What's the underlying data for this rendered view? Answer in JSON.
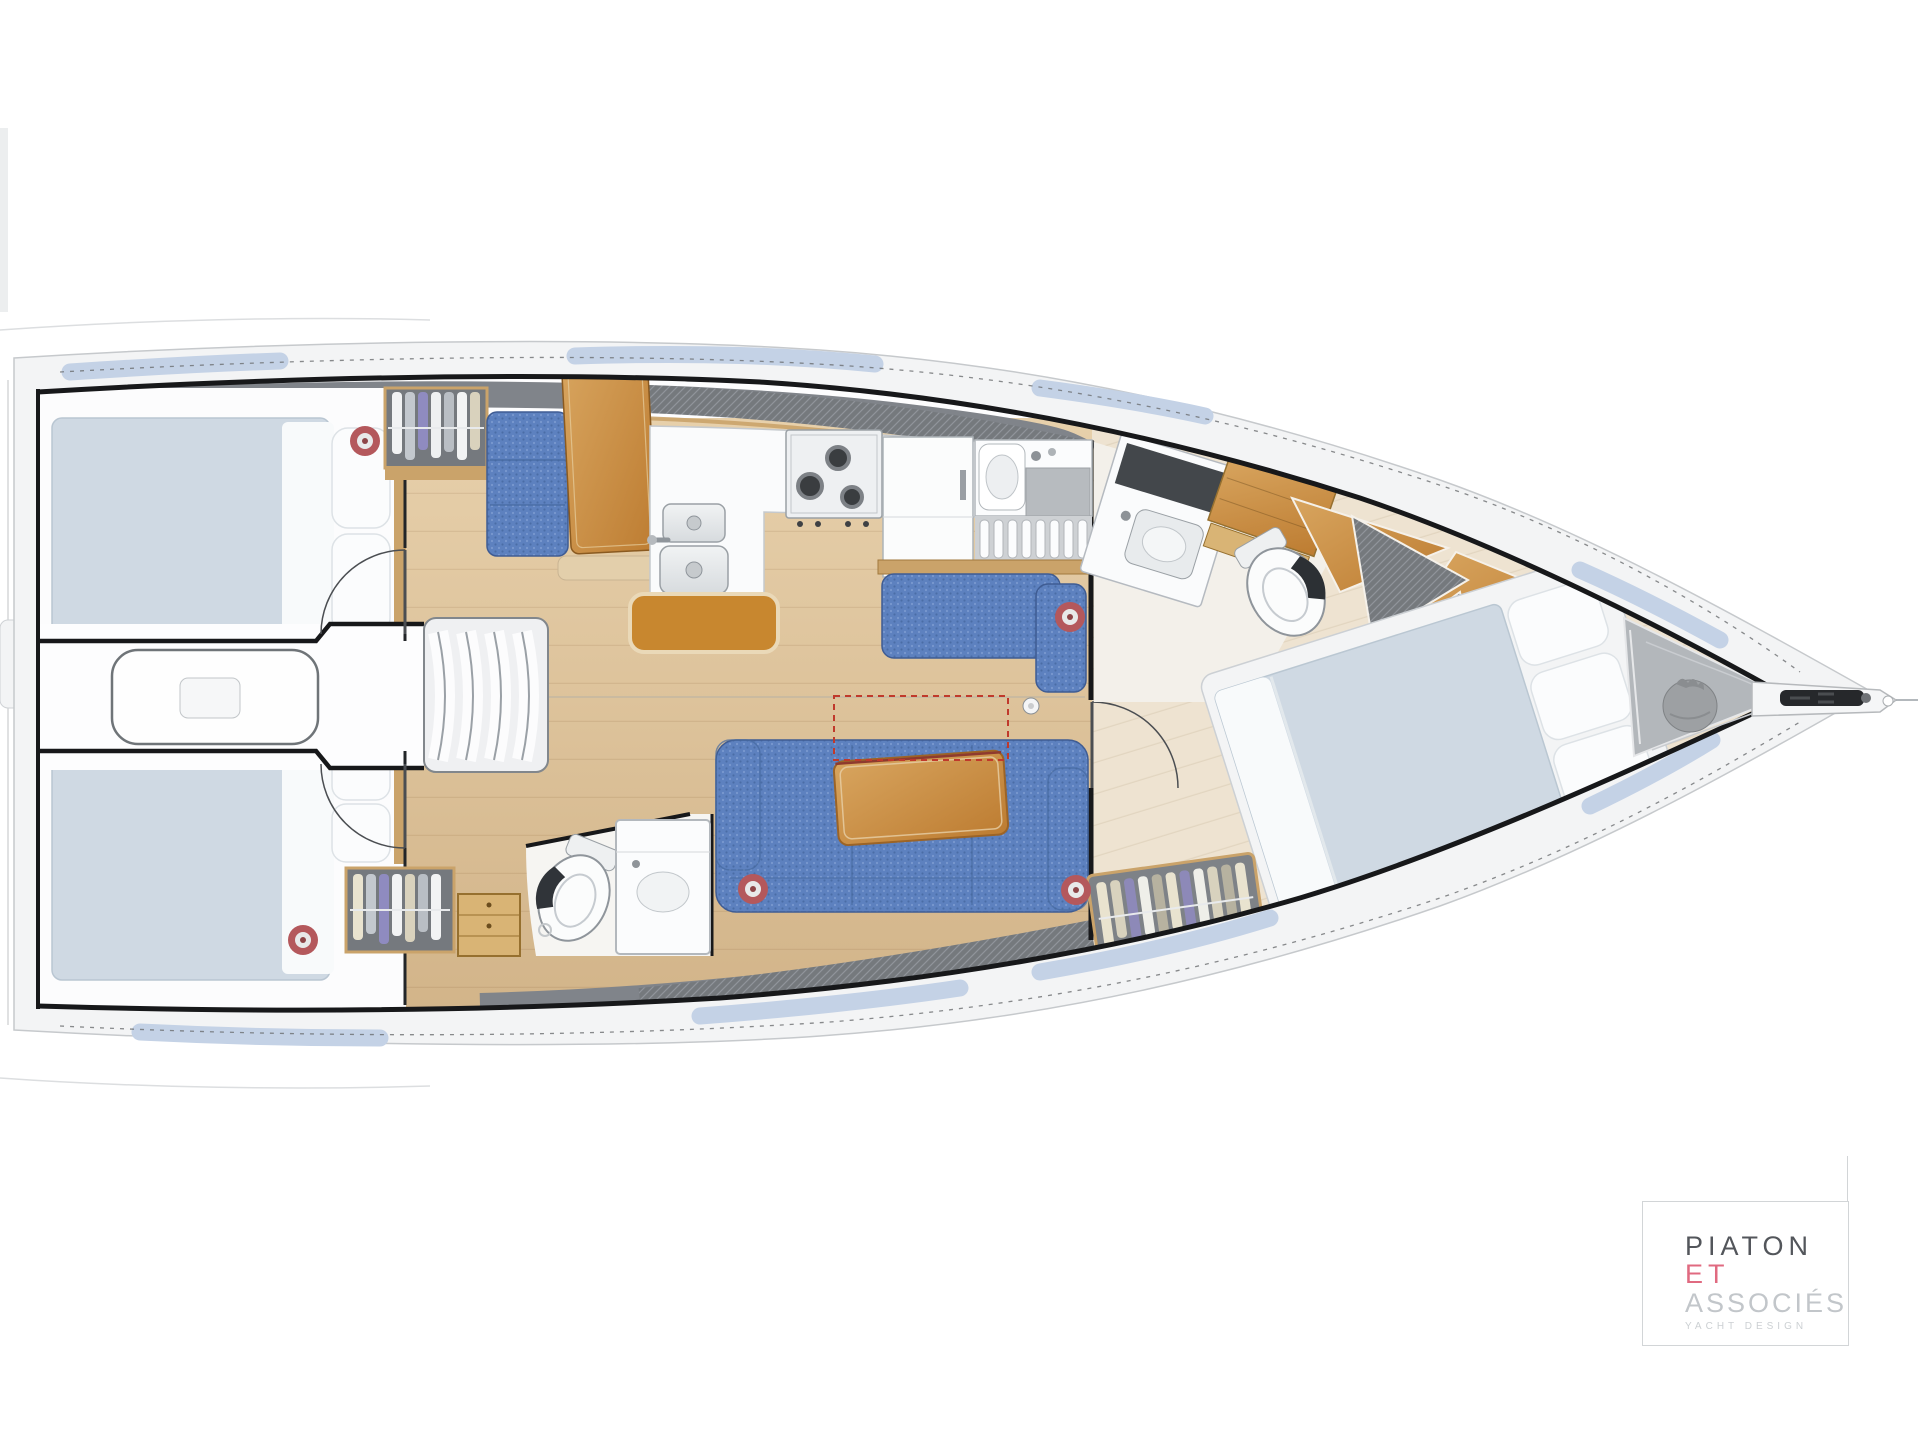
{
  "branding": {
    "name_line1": "PIATON",
    "name_line2": "ET",
    "name_line3": "ASSOCIÉS",
    "tagline": "YACHT DESIGN"
  },
  "plan": {
    "type": "sailing-yacht interior floor plan, overhead view, bow to the right",
    "features": [
      "aft cabin port with double berth",
      "aft cabin starboard with double berth",
      "engine box and companionway steps",
      "hanging wardrobe aft-port",
      "navigation seat and chart table",
      "L-shaped galley with twin sinks, 3-burner stove, refrigerator, wet locker",
      "upper settee with armrest",
      "main saloon settee with fiddled table",
      "folding table extension shown dashed in red",
      "aft heads with toilet and vanity",
      "forward heads with vanity, lockers and toilet",
      "forward cabin island double berth",
      "forward hanging wardrobe",
      "anchor locker with sail bag",
      "bow fitting with anchor roller",
      "five hull portholes marked red",
      "side decks with blue gelcoat strips"
    ]
  },
  "colors": {
    "hullLine": "#17181a",
    "deckBand": "#f3f4f5",
    "deckEdge": "#c6c9cc",
    "stripBlue": "#c4d2e6",
    "grayBand": "#80848a",
    "woodTrim": "#caa36a",
    "floorLight": "#e7d0ab",
    "floorDark": "#d2b489",
    "floorFwd": "#eee3d1",
    "mattress": "#cfd9e3",
    "bedding": "#fbfcfd",
    "fabricBlue": "#5d81bf",
    "fabricDark": "#43669f",
    "orangeWood": "#c8872f",
    "tableLight": "#d8a55f",
    "tableDeep": "#bd7c31",
    "fixtureStroke": "#9aa0a5",
    "portholeRed": "#b4585c",
    "dashRed": "#c0392b",
    "lockerGray": "#75797e",
    "bagGray": "#9da0a3",
    "anchorTri": "#b3b7bb",
    "logoDark": "#53565b",
    "logoPink": "#e06a80",
    "logoGray": "#c2c6ca",
    "logoLight": "#ccd0d3",
    "logoBorder": "#d2d5d7"
  }
}
